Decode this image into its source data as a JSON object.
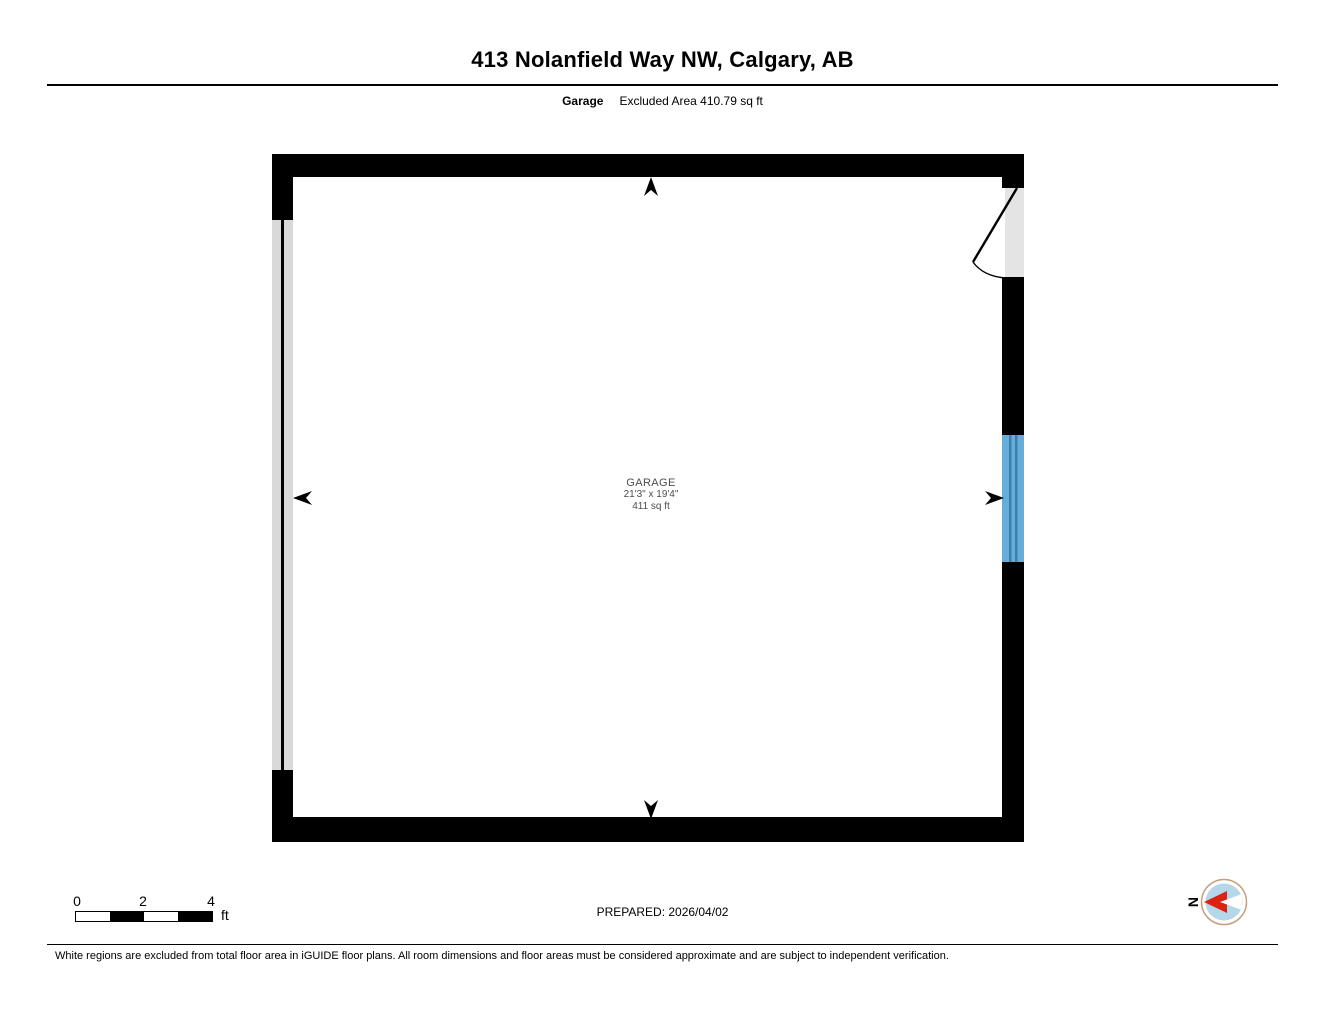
{
  "header": {
    "title": "413 Nolanfield Way NW, Calgary, AB",
    "floor_label": "Garage",
    "excluded_area": "Excluded Area 410.79 sq ft"
  },
  "room": {
    "name": "GARAGE",
    "dimensions": "21'3\" x 19'4\"",
    "area": "411 sq ft"
  },
  "scale_bar": {
    "ticks": [
      "0",
      "2",
      "4"
    ],
    "unit": "ft"
  },
  "footer": {
    "prepared": "PREPARED: 2026/04/02",
    "disclaimer": "White regions are excluded from total floor area in iGUIDE floor plans. All room dimensions and floor areas must be considered approximate and are subject to independent verification."
  },
  "compass": {
    "label": "N"
  },
  "colors": {
    "wall": "#000000",
    "garage_door_strip": "#d9d9d9",
    "door_opening": "#e4e4e4",
    "window": "#64aed9",
    "window_pane": "#3a82a9",
    "room_label_text": "#4d4d4d",
    "compass_ring": "#c79f7a",
    "compass_fill": "#b4d7ea",
    "compass_arrow_red": "#dd2211"
  }
}
